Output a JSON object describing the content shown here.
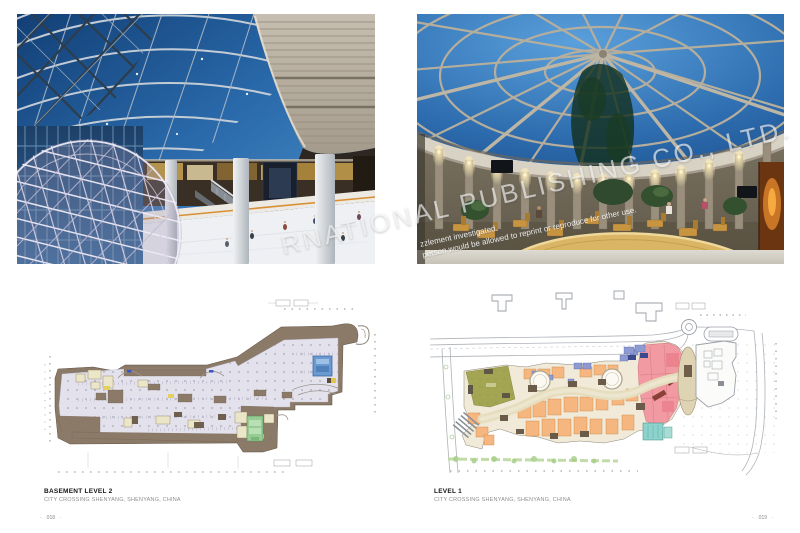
{
  "captions": {
    "left": {
      "title": "BASEMENT LEVEL 2",
      "subtitle": "CITY CROSSING SHENYANG, SHENYANG, CHINA"
    },
    "right": {
      "title": "LEVEL 1",
      "subtitle": "CITY CROSSING SHENYANG, SHENYANG, CHINA"
    }
  },
  "folio": {
    "left": "018",
    "right": "019",
    "marker": "·"
  },
  "watermark": {
    "main": "RNATIONAL PUBLISHING CO., LTD.",
    "line1": "zzlement investigated.",
    "line2": "person would be allowed to reprint or reproduce for other use."
  },
  "photos": {
    "left": {
      "alt": "mall atrium with curved gridshell skylight, stone fascia, white lattice sphere and indoor ice rink"
    },
    "right": {
      "alt": "circular atrium with radial glazed dome, uplit stone drum wall, cafe seating and curved beige counter"
    }
  },
  "palette": {
    "sky_blue": "#2a6aab",
    "stone": "#b2a996",
    "plan_brown": "#8c7a68",
    "plan_field": "#e3e2ec",
    "plan_blue": "#6b9ad0",
    "plan_green": "#96cb93",
    "plan_olive": "#a3a553",
    "plan_orange": "#f6b67f",
    "plan_pink": "#f19aa2",
    "plan_teal": "#8ed2cc",
    "counter_beige": "#dab566",
    "watermark": "#ffffff"
  }
}
